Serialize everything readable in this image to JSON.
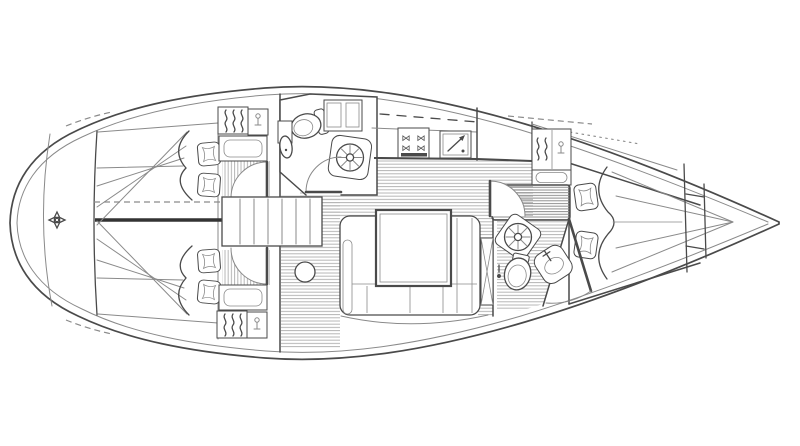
{
  "colors": {
    "background": "#ffffff",
    "line": "#4a4a4a",
    "line_light": "#8a8a8a",
    "hatch": "#b5b5b5",
    "hatch_dense": "#8f8f8f",
    "thick_divider": "#333333"
  },
  "icons": {
    "stove_burner": "⋈"
  },
  "plan": {
    "type": "sailing-yacht-interior-floor-plan-top-view",
    "hull_ends": [
      "rounded-left-end",
      "pointed-right-end"
    ],
    "compartments": [
      {
        "id": "cabin-left-upper",
        "berth": "double",
        "pillows": 2,
        "furniture": [
          "hanging-locker",
          "vanity-locker",
          "cabinet",
          "louvre-floor",
          "door"
        ]
      },
      {
        "id": "cabin-left-lower",
        "berth": "double",
        "pillows": 2,
        "furniture": [
          "hanging-locker",
          "vanity-locker",
          "cabinet",
          "louvre-floor",
          "door"
        ]
      },
      {
        "id": "companionway-center",
        "furniture": [
          "steps",
          "mast-post"
        ]
      },
      {
        "id": "head-top-center",
        "furniture": [
          "toilet",
          "washbasin",
          "wall-cabinet",
          "shower",
          "door"
        ]
      },
      {
        "id": "galley-top",
        "furniture": [
          "top-lockers",
          "stove-4-burner",
          "chart-locker-with-arrow",
          "worktop"
        ]
      },
      {
        "id": "saloon-center",
        "furniture": [
          "u-shaped-settee",
          "table",
          "bench-divisions",
          "backrest"
        ]
      },
      {
        "id": "head-bottom-right",
        "furniture": [
          "shower",
          "toilet",
          "washbasin",
          "door"
        ]
      },
      {
        "id": "cabin-right",
        "berth": "tapered-double",
        "pillows": 2,
        "furniture": [
          "hanging-locker",
          "vanity-locker",
          "shelf",
          "slatted-seat",
          "mirror-locker",
          "door"
        ]
      },
      {
        "id": "tip-right",
        "furniture": [
          "bulkheads",
          "stowage"
        ]
      },
      {
        "id": "dome-left",
        "furniture": [
          "windlass-symbol"
        ]
      }
    ]
  }
}
